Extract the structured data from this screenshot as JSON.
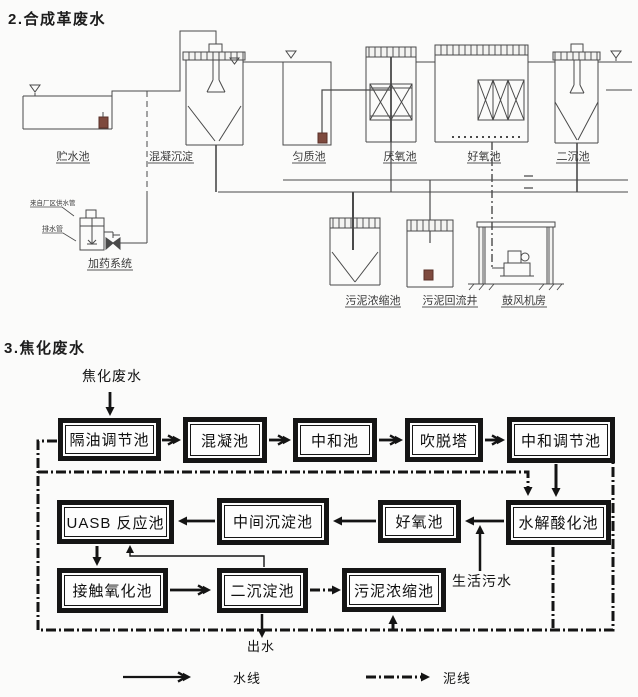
{
  "colors": {
    "drawing_line": "#4a4a4a",
    "flow_line": "#141414",
    "background": "#fbfbfa",
    "pump_accent": "#7e4a3e"
  },
  "sections": {
    "s2": {
      "title": "2.合成革废水",
      "drawing": {
        "labels": {
          "storage_tank": "贮水池",
          "coag_sedimentation": "混凝沉淀",
          "homogenization_tank": "匀质池",
          "anaerobic_tank": "厌氧池",
          "aerobic_tank": "好氧池",
          "secondary_clarifier": "二沉池",
          "dosing_system": "加药系统",
          "sludge_thickener": "污泥浓缩池",
          "sludge_return_well": "污泥回流井",
          "blower_room": "鼓风机房",
          "from_plant_water": "来自厂区供水管",
          "drain_pipe": "排水管"
        }
      }
    },
    "s3": {
      "title": "3.焦化废水",
      "flowchart": {
        "input_label": "焦化废水",
        "boxes": [
          {
            "label": "隔油调节池"
          },
          {
            "label": "混凝池"
          },
          {
            "label": "中和池"
          },
          {
            "label": "吹脱塔"
          },
          {
            "label": "中和调节池"
          },
          {
            "label": "UASB 反应池"
          },
          {
            "label": "中间沉淀池"
          },
          {
            "label": "好氧池"
          },
          {
            "label": "水解酸化池"
          },
          {
            "label": "接触氧化池"
          },
          {
            "label": "二沉淀池"
          },
          {
            "label": "污泥浓缩池"
          }
        ],
        "annotations": {
          "domestic_sewage": "生活污水",
          "effluent": "出水"
        },
        "legend": {
          "water_line": "水线",
          "sludge_line": "泥线"
        }
      }
    }
  }
}
